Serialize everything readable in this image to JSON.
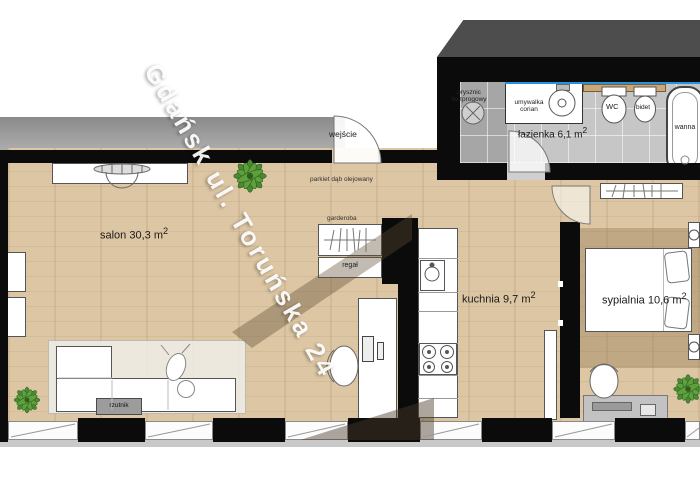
{
  "watermark": "Gdańsk ul. Toruńska 24",
  "labels": {
    "entrance": "wejście",
    "floor_material": "parkiet dąb olejowany",
    "wardrobe": "garderoba",
    "shelf": "regał",
    "projector": "rzutnik"
  },
  "rooms": {
    "living": {
      "name": "salon 30,3 m",
      "sup": "2"
    },
    "kitchen": {
      "name": "kuchnia 9,7 m",
      "sup": "2"
    },
    "bedroom": {
      "name": "sypialnia 10,6 m",
      "sup": "2"
    },
    "bathroom": {
      "name": "łazienka 6,1 m",
      "sup": "2"
    }
  },
  "bathroom_fixtures": {
    "shower": {
      "line1": "prysznic",
      "line2": "bezprogowy"
    },
    "washbasin": {
      "line1": "umywalka",
      "line2": "corian"
    },
    "wc": "WC",
    "bidet": "bidet",
    "bathtub": "wanna"
  },
  "colors": {
    "wood_floor": "#dcc6a3",
    "wall": "#0b0b0b",
    "tile": "#c6c6c6",
    "shower_tile": "#a6a6a6",
    "glass_blue": "#2196d9",
    "terrace_gray": "#979797",
    "roof_band": "#4d4d4d",
    "plant_green": "#4a8a33"
  }
}
